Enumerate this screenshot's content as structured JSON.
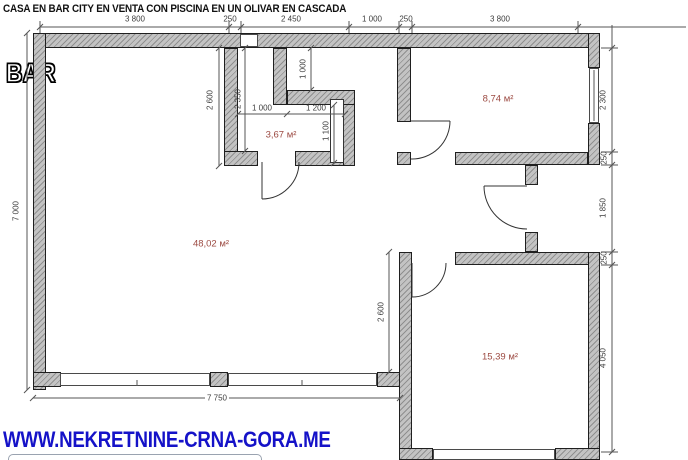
{
  "title": "CASA EN BAR CITY EN VENTA CON PISCINA EN UN OLIVAR EN CASCADA",
  "location_label": "BAR",
  "watermark": "WWW.NEKRETNINE-CRNA-GORA.ME",
  "rooms": {
    "living": {
      "area": "48,02 м²"
    },
    "bathroom": {
      "area": "3,67 м²"
    },
    "bedroom_top": {
      "area": "8,74 м²"
    },
    "bedroom_bottom": {
      "area": "15,39 м²"
    }
  },
  "dimensions": {
    "top": [
      "3 800",
      "250",
      "2 450",
      "1 000",
      "250",
      "3 800"
    ],
    "left_total": "7 000",
    "bottom_total": "7 750",
    "right": [
      "2 300",
      "250",
      "1 850",
      "250",
      "4 050"
    ],
    "interior": {
      "bath_outer_height": "2 600",
      "bath_inner_height": "2 350",
      "bath_lower_width_left": "1 000",
      "bath_lower_width_right": "1 200",
      "niche_height": "1 000",
      "bath_right_height": "1 100",
      "living_right_height": "2 600"
    }
  },
  "colors": {
    "wall_fill": "#c3c3c3",
    "wall_hatch": "#8f8f8f",
    "line": "#3d3d3d",
    "room_label": "#9c4a42",
    "watermark_blue": "#1512c8"
  }
}
